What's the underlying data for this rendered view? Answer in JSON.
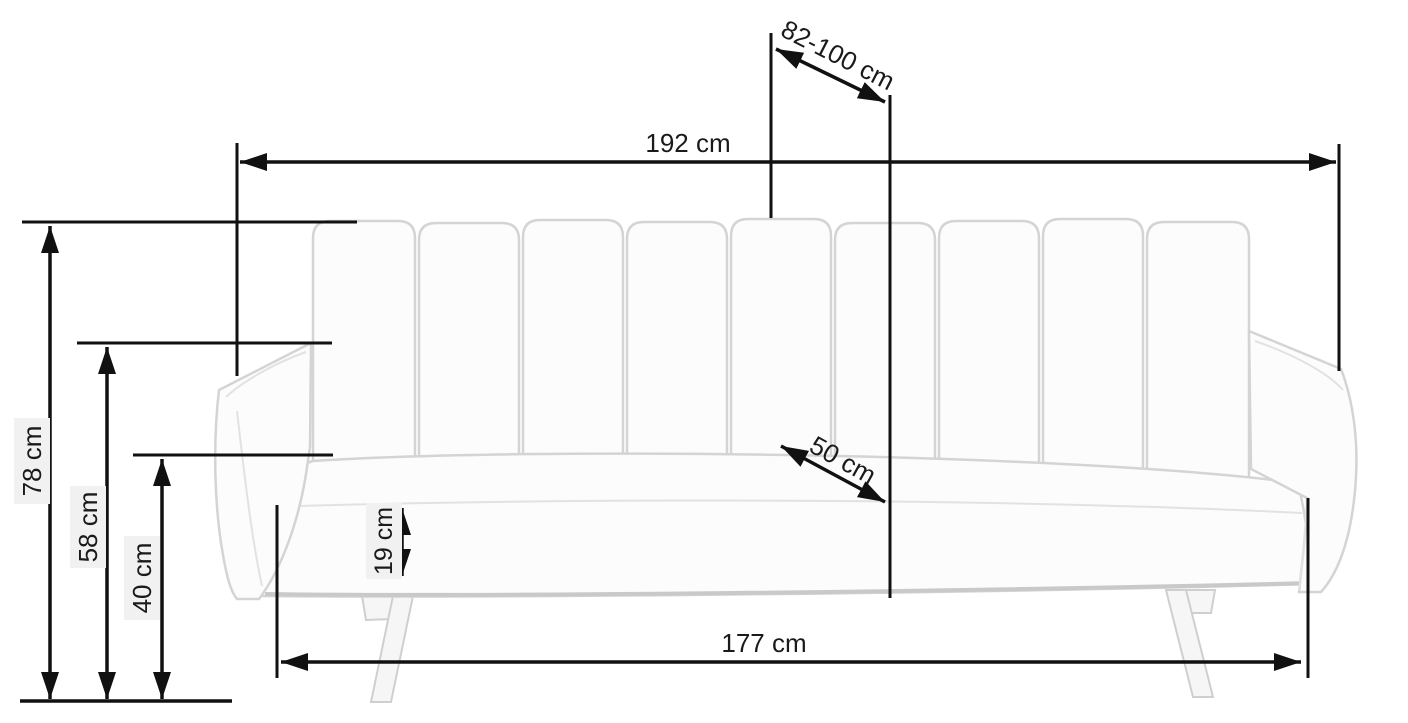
{
  "diagram": {
    "subject": "sofa-bed-dimension-drawing",
    "unit": "cm",
    "dimensions": {
      "total_width": "192 cm",
      "bed_depth_range": "82-100 cm",
      "total_height": "78 cm",
      "armrest_height": "58 cm",
      "seat_height": "40 cm",
      "seat_cushion_thickness": "19 cm",
      "seat_depth": "50 cm",
      "base_width": "177 cm"
    },
    "colors": {
      "dimension_lines": "#111111",
      "sofa_outline": "#d4d4d4",
      "sofa_fill": "#fcfcfc",
      "label_background": "#f1f1f1",
      "background": "#ffffff"
    }
  }
}
